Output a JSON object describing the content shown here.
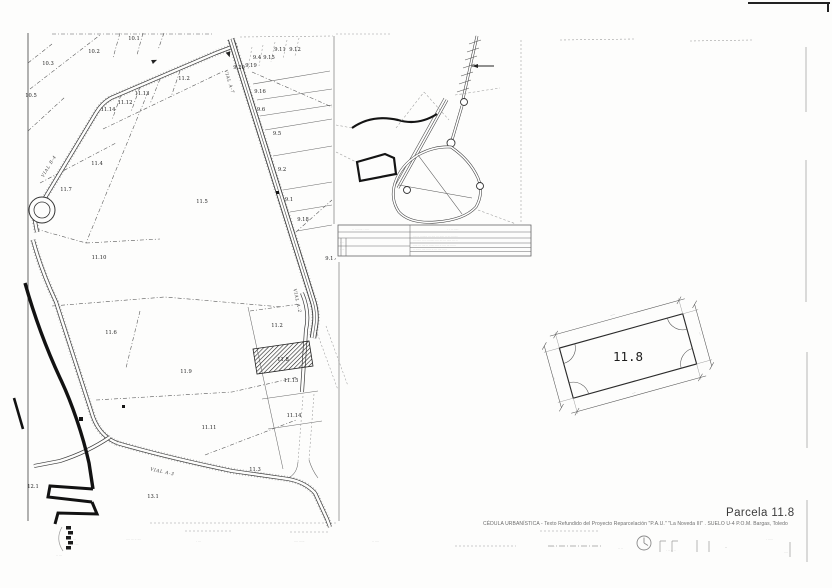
{
  "sheet": {
    "title": "Parcela 11.8",
    "subtitle": "CÉDULA URBANÍSTICA - Texto Refundido del Proyecto Reparcelación \"P.A.U.\" \"La Noveda III\" . SUELO U-4 P.O.M. Bargas, Toledo"
  },
  "parcel_detail": {
    "label": "11.8"
  },
  "parcel_map": {
    "parcel_labels": [
      {
        "t": "10.2",
        "x": 94,
        "y": 53
      },
      {
        "t": "10.3",
        "x": 48,
        "y": 65
      },
      {
        "t": "10.5",
        "x": 31,
        "y": 97
      },
      {
        "t": "10.1",
        "x": 134,
        "y": 40
      },
      {
        "t": "11.14",
        "x": 108,
        "y": 111
      },
      {
        "t": "11.12",
        "x": 125,
        "y": 104
      },
      {
        "t": "11.13",
        "x": 142,
        "y": 95
      },
      {
        "t": "11.2",
        "x": 184,
        "y": 80
      },
      {
        "t": "11.4",
        "x": 97,
        "y": 165
      },
      {
        "t": "11.7",
        "x": 66,
        "y": 191
      },
      {
        "t": "11.5",
        "x": 202,
        "y": 203
      },
      {
        "t": "11.10",
        "x": 99,
        "y": 259
      },
      {
        "t": "11.6",
        "x": 111,
        "y": 334
      },
      {
        "t": "11.9",
        "x": 186,
        "y": 373
      },
      {
        "t": "11.11",
        "x": 209,
        "y": 429
      },
      {
        "t": "11.2",
        "x": 277,
        "y": 327
      },
      {
        "t": "11.8",
        "x": 283,
        "y": 361,
        "cls": "hatchlbl"
      },
      {
        "t": "11.15",
        "x": 291,
        "y": 382
      },
      {
        "t": "11.14",
        "x": 294,
        "y": 417
      },
      {
        "t": "11.3",
        "x": 255,
        "y": 471
      },
      {
        "t": "12.1",
        "x": 33,
        "y": 488
      },
      {
        "t": "13.1",
        "x": 153,
        "y": 498
      },
      {
        "t": "9.11",
        "x": 280,
        "y": 51
      },
      {
        "t": "9.12",
        "x": 295,
        "y": 51
      },
      {
        "t": "9.4",
        "x": 257,
        "y": 59
      },
      {
        "t": "9.15",
        "x": 269,
        "y": 59
      },
      {
        "t": "9.20",
        "x": 239,
        "y": 69
      },
      {
        "t": "9.19",
        "x": 251,
        "y": 67
      },
      {
        "t": "9.16",
        "x": 260,
        "y": 93
      },
      {
        "t": "9.6",
        "x": 261,
        "y": 111
      },
      {
        "t": "9.5",
        "x": 277,
        "y": 135
      },
      {
        "t": "9.2",
        "x": 282,
        "y": 171
      },
      {
        "t": "9.1",
        "x": 289,
        "y": 201
      },
      {
        "t": "9.18",
        "x": 303,
        "y": 221
      },
      {
        "t": "9.17",
        "x": 331,
        "y": 260
      }
    ],
    "road_labels": [
      {
        "t": "VIAL A-7",
        "x": 228,
        "y": 82,
        "rot": 73
      },
      {
        "t": "VIAL A-2",
        "x": 296,
        "y": 301,
        "rot": 78
      },
      {
        "t": "VIAL B-4",
        "x": 50,
        "y": 167,
        "rot": -59
      },
      {
        "t": "VIAL A-3",
        "x": 162,
        "y": 473,
        "rot": 12
      }
    ]
  },
  "micro_texts": [
    {
      "t": "·· ········ · ····",
      "x": 352,
      "y": 230,
      "s": 3
    },
    {
      "t": "· · ·· ·····",
      "x": 447,
      "y": 230,
      "s": 3
    },
    {
      "t": "···· ·· ········ ··· ···· ··· ····· ·· ··· ·······",
      "x": 413,
      "y": 237,
      "s": 2.8
    },
    {
      "t": "··· ····· ·· ·· ········ ···· ··· ··· ····· ··· ··",
      "x": 413,
      "y": 241.5,
      "s": 2.8
    },
    {
      "t": "····· ··· ···· ·· ······ ···· ·· ···· ··· ······",
      "x": 413,
      "y": 246,
      "s": 2.8
    },
    {
      "t": "·· ······ ···· ····· ·· ··· ···· ·····",
      "x": 413,
      "y": 250.5,
      "s": 2.8
    },
    {
      "t": "····",
      "x": 340,
      "y": 243,
      "s": 2.8
    },
    {
      "t": "· ···",
      "x": 340,
      "y": 250,
      "s": 2.8
    },
    {
      "t": "·· ···",
      "x": 70,
      "y": 540,
      "s": 3
    },
    {
      "t": "· ·· ·· · ···",
      "x": 66,
      "y": 545,
      "s": 3
    },
    {
      "t": "·· ···",
      "x": 56,
      "y": 556,
      "s": 3
    },
    {
      "t": "···· ··· ·· ····",
      "x": 126,
      "y": 540,
      "s": 3
    },
    {
      "t": "· ···",
      "x": 196,
      "y": 542,
      "s": 3
    },
    {
      "t": "···· ······",
      "x": 294,
      "y": 542,
      "s": 3
    },
    {
      "t": "·· ····",
      "x": 372,
      "y": 542,
      "s": 3
    },
    {
      "t": "·····",
      "x": 550,
      "y": 547,
      "s": 3
    },
    {
      "t": "·· ··",
      "x": 618,
      "y": 549,
      "s": 3
    },
    {
      "t": "· ·· ·· ··",
      "x": 666,
      "y": 551,
      "s": 3
    },
    {
      "t": "··",
      "x": 725,
      "y": 549,
      "s": 3.2
    },
    {
      "t": "· ·····",
      "x": 766,
      "y": 540,
      "s": 3
    },
    {
      "t": "····",
      "x": 784,
      "y": 553,
      "s": 3
    },
    {
      "t": "·····",
      "x": 613,
      "y": 316,
      "s": 3,
      "rot": -15.5,
      "cls": "microc"
    },
    {
      "t": "····",
      "x": 634,
      "y": 394,
      "s": 3,
      "rot": -15.5,
      "cls": "microc"
    },
    {
      "t": "····",
      "x": 553,
      "y": 378,
      "s": 3,
      "rot": 74.5,
      "cls": "microc"
    },
    {
      "t": "····",
      "x": 699,
      "y": 334,
      "s": 3,
      "rot": 74.5,
      "cls": "microc"
    }
  ]
}
